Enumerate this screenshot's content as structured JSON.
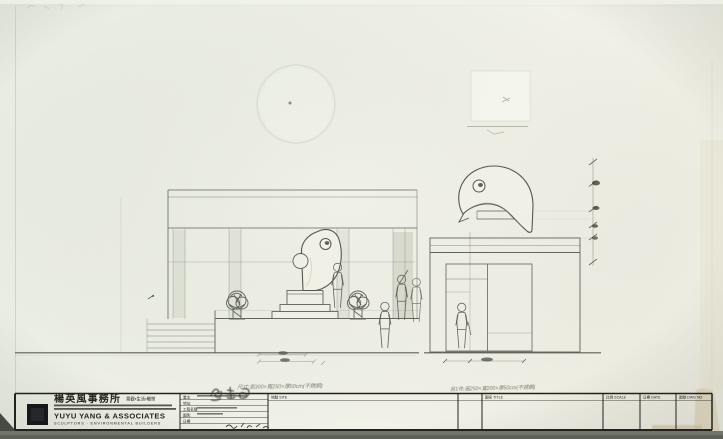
{
  "sheet": {
    "annotations": {
      "left_note": "尺寸:高300×寬250×厚50cm(不銹鋼)",
      "right_note": "另1件:高250×寬200×厚50cm(不銹鋼)"
    },
    "title_block": {
      "logo": {
        "firm_name_zh": "楊英風事務所",
        "tagline_zh": "景觀•生活•雕塑",
        "firm_name_en": "YUYU YANG & ASSOCIATES",
        "firm_sub_en": "SCULPTORS · ENVIRONMENTAL BUILDERS"
      },
      "info_rows": {
        "owner": "業主:",
        "address": "地址:",
        "project": "工程名稱:",
        "drawing_type": "圖別:",
        "date": "日期:"
      },
      "cells": {
        "site": "地點 SITE",
        "title": "圖名 TITLE",
        "scale": "比例 SCALE",
        "date": "日期 DATE",
        "dwg_no": "圖號 DWG NO"
      }
    },
    "colors": {
      "paper": "#edeee4",
      "pencil": "#60645a",
      "ink": "#1e1f1a"
    }
  }
}
